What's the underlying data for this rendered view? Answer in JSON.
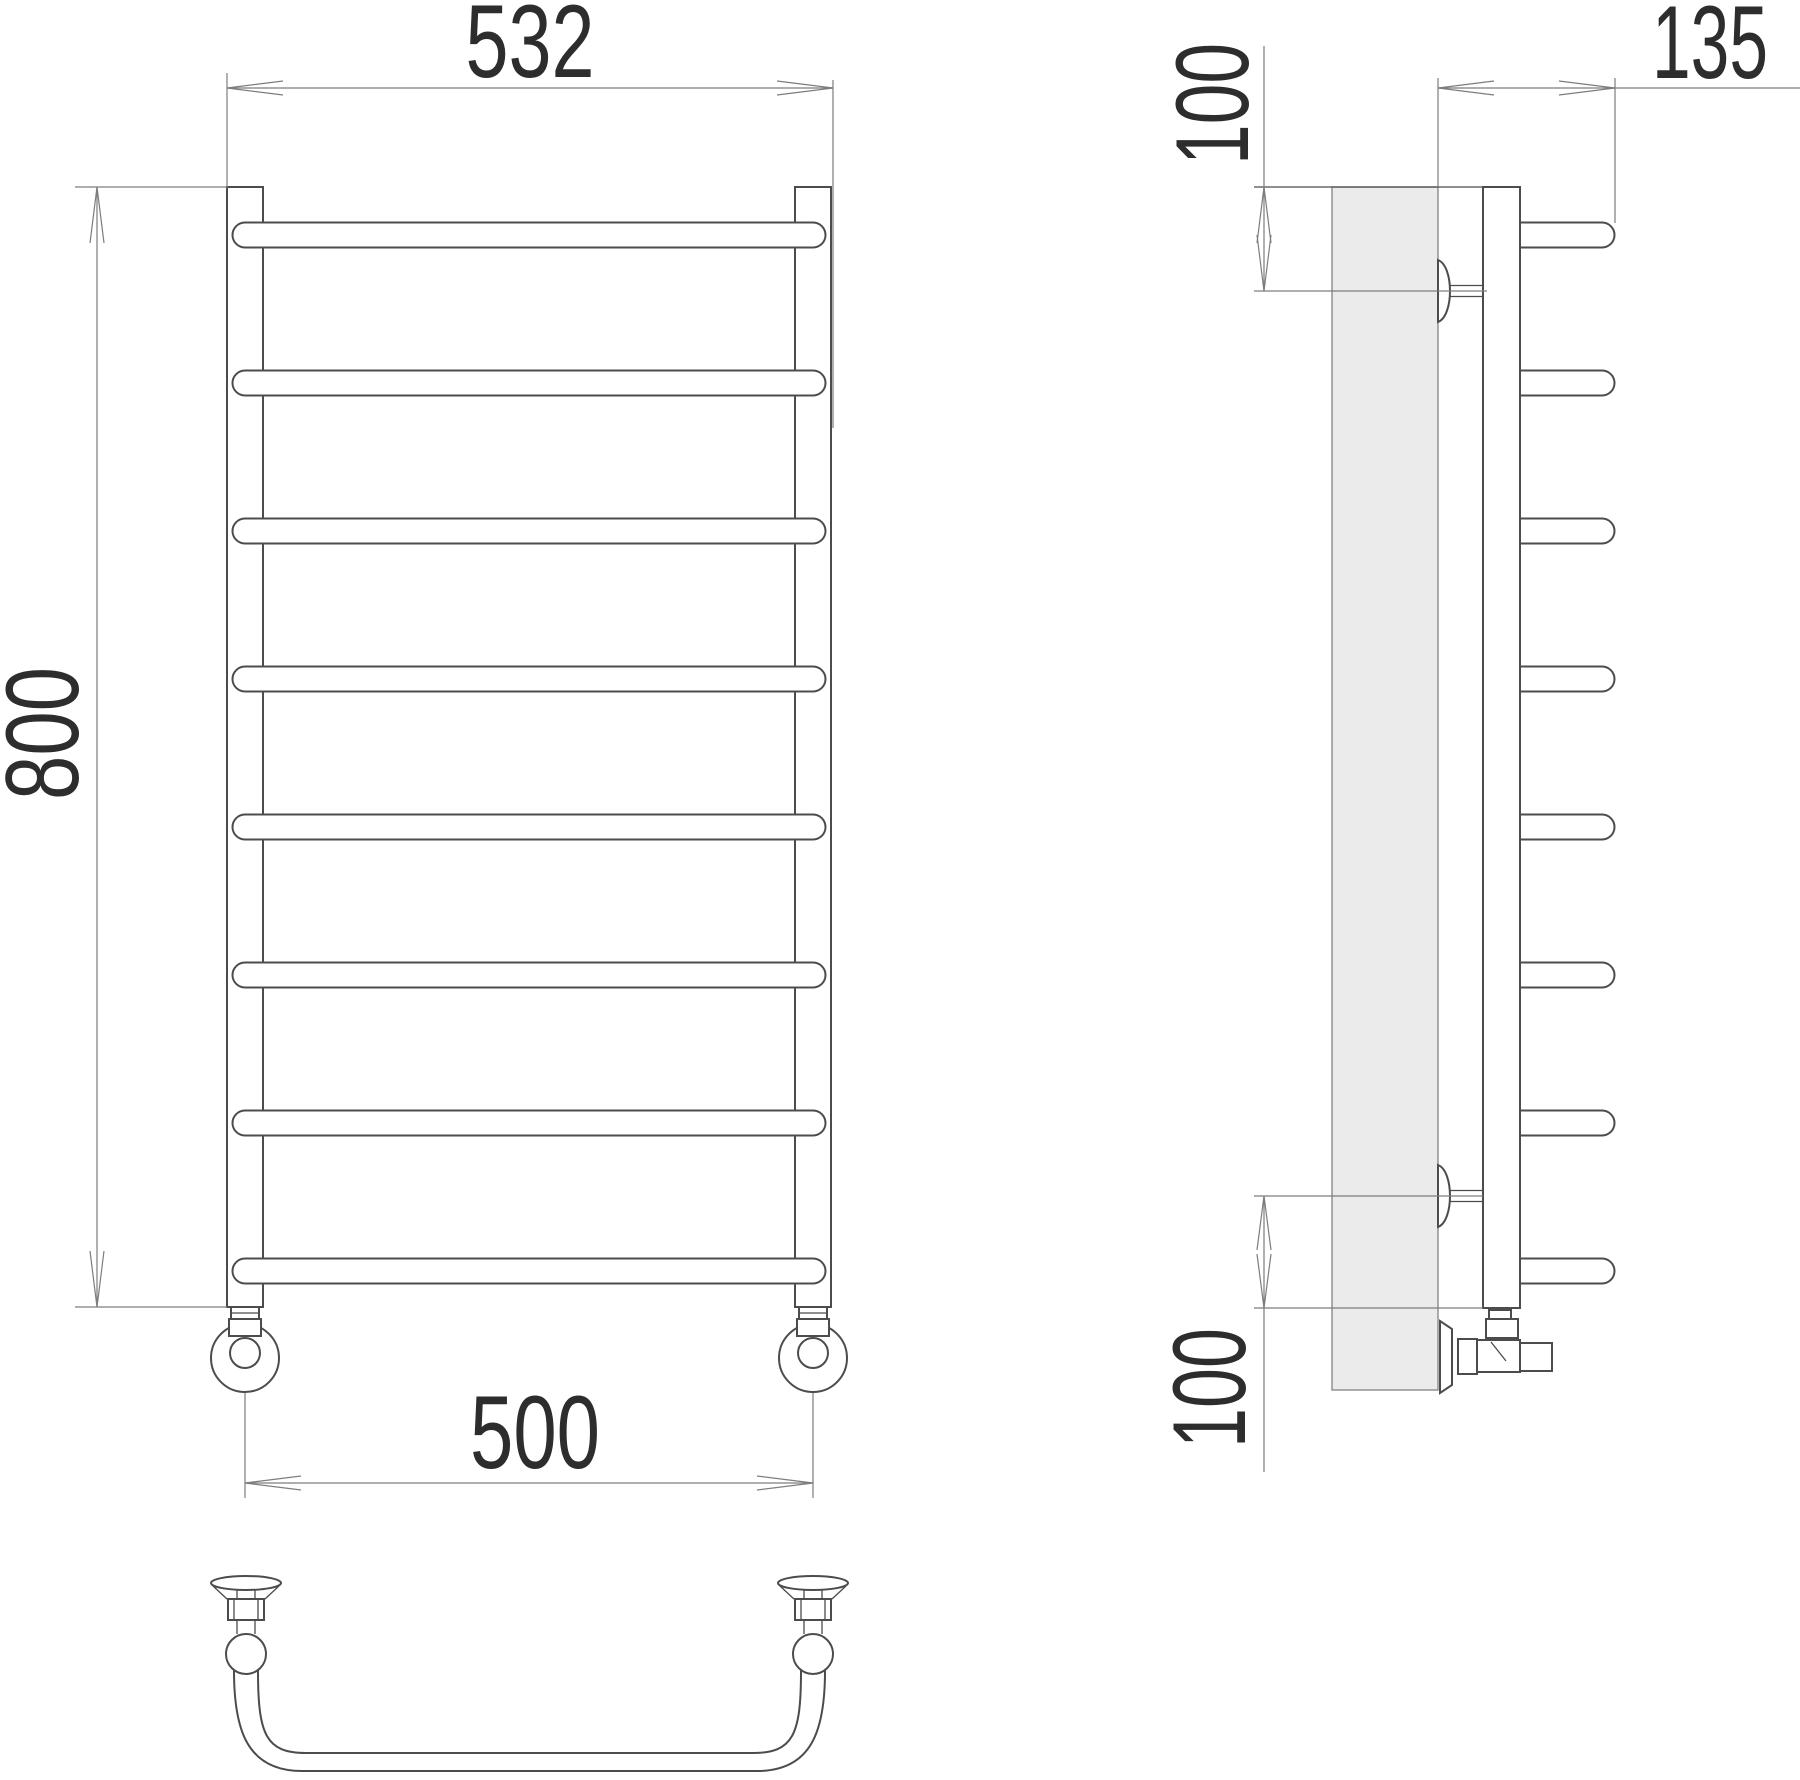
{
  "drawing": {
    "kind": "towel-rail technical drawing, three orthographic views",
    "views": {
      "front": "front view of ladder towel rail with 8 horizontal bars",
      "side": "side view with wall section and mounting brackets",
      "bottom": "top view of curved bar with wall brackets"
    }
  },
  "dimensions": {
    "front_width": "532",
    "front_height": "800",
    "pipe_spacing": "500",
    "side_depth": "135",
    "side_top_offset": "100",
    "side_bottom_offset": "100"
  },
  "colors": {
    "background": "#ffffff",
    "line": "#4c4c4c",
    "dim_line": "#7d7d7d",
    "text": "#2d2d2d",
    "wall_fill": "#ebebeb"
  }
}
